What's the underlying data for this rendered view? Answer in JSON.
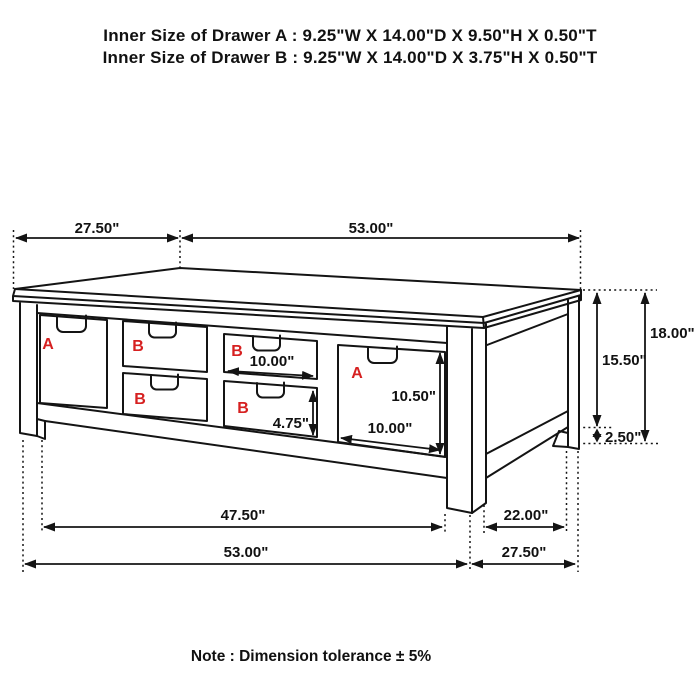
{
  "header": {
    "drawer_a_inner_size": "Inner Size of Drawer A : 9.25\"W X 14.00\"D X 9.50\"H X 0.50\"T",
    "drawer_b_inner_size": "Inner Size of Drawer B : 9.25\"W X 14.00\"D X 3.75\"H X 0.50\"T"
  },
  "note": {
    "text": "Note : Dimension tolerance ± 5%"
  },
  "diagram": {
    "description": "Line drawing of a six-drawer storage coffee table with dimension annotations",
    "colors": {
      "line": "#141414",
      "dimension_text": "#111111",
      "drawer_label_red": "#d62020",
      "background": "#ffffff"
    },
    "drawer_labels": {
      "left_a": "A",
      "mid_upper_b": "B",
      "mid_lower_b": "B",
      "right_upper_b": "B",
      "right_lower_b": "B",
      "right_a": "A"
    },
    "dims": {
      "top_depth": "27.50\"",
      "top_width": "53.00\"",
      "overall_height": "18.00\"",
      "apron_height": "15.50\"",
      "foot_height": "2.50\"",
      "drawer_b_width": "10.00\"",
      "drawer_b_height": "4.75\"",
      "drawer_a_height": "10.50\"",
      "drawer_a_width": "10.00\"",
      "front_leg_span": "47.50\"",
      "side_leg_span": "22.00\"",
      "bottom_width": "53.00\"",
      "bottom_depth": "27.50\""
    }
  }
}
